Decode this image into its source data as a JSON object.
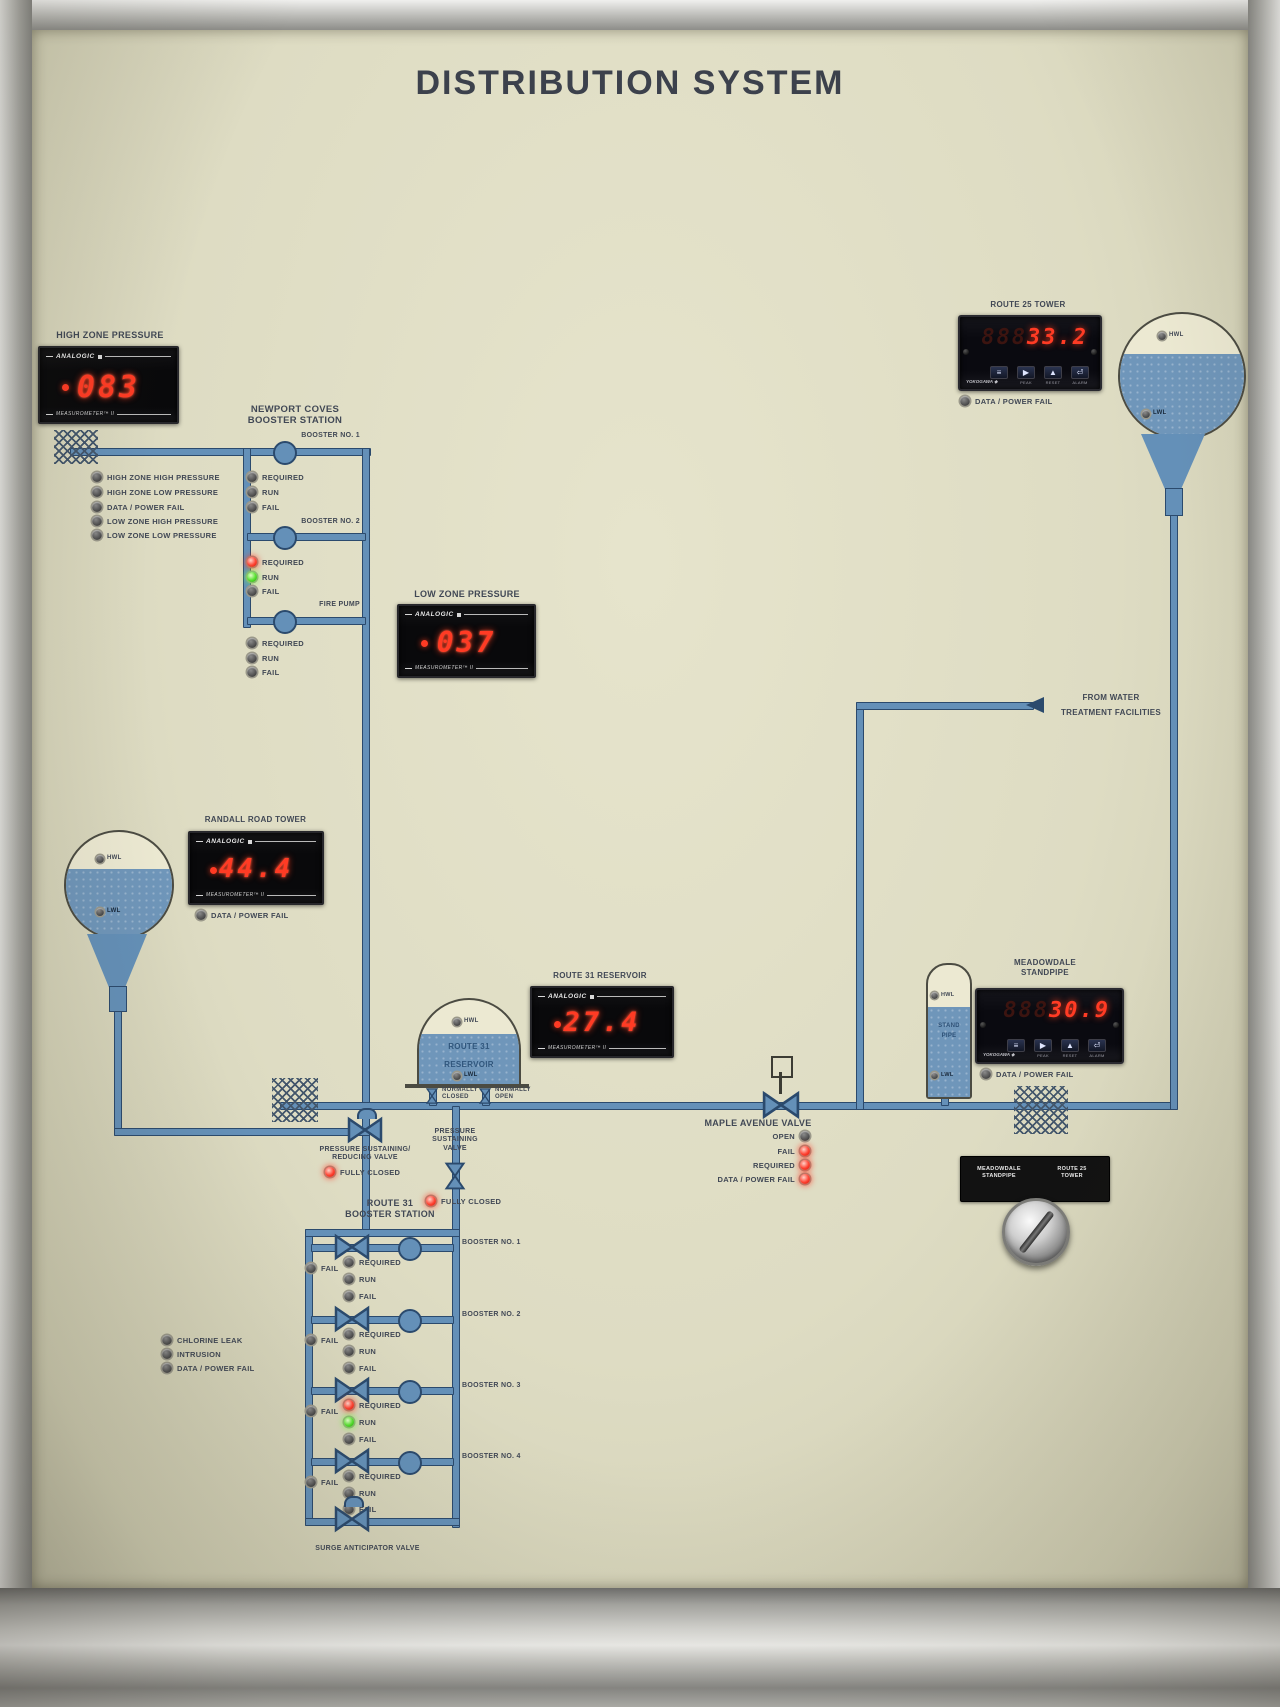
{
  "title": "DISTRIBUTION SYSTEM",
  "meters": {
    "high_zone": {
      "label": "HIGH ZONE PRESSURE",
      "value": "083",
      "brand": "ANALOGIC",
      "footer": "MEASUROMETER™ II"
    },
    "low_zone": {
      "label": "LOW ZONE PRESSURE",
      "value": "037",
      "brand": "ANALOGIC",
      "footer": "MEASUROMETER™ II"
    },
    "randall": {
      "label": "RANDALL ROAD TOWER",
      "value": "44.4",
      "brand": "ANALOGIC",
      "footer": "MEASUROMETER™ II",
      "fail": {
        "label": "DATA / POWER FAIL",
        "state": "off"
      }
    },
    "route31": {
      "label": "ROUTE 31 RESERVOIR",
      "value": "27.4",
      "brand": "ANALOGIC",
      "footer": "MEASUROMETER™ II"
    },
    "route25": {
      "label": "ROUTE 25 TOWER",
      "ghost": "888",
      "value": "33.2",
      "brand": "YOKOGAWA ◆",
      "buttons": [
        "≡",
        "▶",
        "▲",
        "⏎"
      ],
      "button_labels": [
        "",
        "PEAK",
        "RESET",
        "ALARM"
      ],
      "fail": {
        "label": "DATA / POWER FAIL",
        "state": "off"
      }
    },
    "meadowdale": {
      "label_line1": "MEADOWDALE",
      "label_line2": "STANDPIPE",
      "ghost": "888",
      "value": "30.9",
      "brand": "YOKOGAWA ◆",
      "buttons": [
        "≡",
        "▶",
        "▲",
        "⏎"
      ],
      "button_labels": [
        "",
        "PEAK",
        "RESET",
        "ALARM"
      ],
      "fail": {
        "label": "DATA / POWER FAIL",
        "state": "off"
      }
    }
  },
  "newport": {
    "title_line1": "NEWPORT COVES",
    "title_line2": "BOOSTER STATION",
    "zone_alarms": [
      {
        "label": "HIGH ZONE HIGH PRESSURE",
        "state": "off"
      },
      {
        "label": "HIGH ZONE LOW PRESSURE",
        "state": "off"
      },
      {
        "label": "DATA / POWER FAIL",
        "state": "off"
      },
      {
        "label": "LOW ZONE HIGH PRESSURE",
        "state": "off"
      },
      {
        "label": "LOW ZONE LOW PRESSURE",
        "state": "off"
      }
    ],
    "booster1": {
      "name": "BOOSTER NO. 1",
      "lights": [
        {
          "label": "REQUIRED",
          "state": "off"
        },
        {
          "label": "RUN",
          "state": "off"
        },
        {
          "label": "FAIL",
          "state": "off"
        }
      ]
    },
    "booster2": {
      "name": "BOOSTER NO. 2",
      "lights": [
        {
          "label": "REQUIRED",
          "state": "red"
        },
        {
          "label": "RUN",
          "state": "green"
        },
        {
          "label": "FAIL",
          "state": "off"
        }
      ]
    },
    "fire_pump": {
      "name": "FIRE PUMP",
      "lights": [
        {
          "label": "REQUIRED",
          "state": "off"
        },
        {
          "label": "RUN",
          "state": "off"
        },
        {
          "label": "FAIL",
          "state": "off"
        }
      ]
    }
  },
  "from_water": {
    "line1": "FROM WATER",
    "line2": "TREATMENT FACILITIES"
  },
  "towers": {
    "route25_tower": {
      "hwl": "HWL",
      "lwl": "LWL"
    },
    "randall_tower": {
      "hwl": "HWL",
      "lwl": "LWL"
    },
    "reservoir": {
      "line1": "ROUTE 31",
      "line2": "RESERVOIR",
      "hwl": "HWL",
      "lwl": "LWL",
      "valve_left_line1": "NORMALLY",
      "valve_left_line2": "CLOSED",
      "valve_right_line1": "NORMALLY",
      "valve_right_line2": "OPEN"
    },
    "standpipe": {
      "hwl": "HWL",
      "line1": "STAND",
      "line2": "PIPE",
      "lwl": "LWL"
    }
  },
  "maple": {
    "title": "MAPLE AVENUE VALVE",
    "rows": [
      {
        "label": "OPEN",
        "state": "off"
      },
      {
        "label": "FAIL",
        "state": "red"
      },
      {
        "label": "REQUIRED",
        "state": "red"
      },
      {
        "label": "DATA / POWER FAIL",
        "state": "red"
      }
    ]
  },
  "selector": {
    "left_line1": "MEADOWDALE",
    "left_line2": "STANDPIPE",
    "right_line1": "ROUTE 25",
    "right_line2": "TOWER"
  },
  "ps_reducing": {
    "line1": "PRESSURE SUSTAINING/",
    "line2": "REDUCING VALVE",
    "light": {
      "label": "FULLY CLOSED",
      "state": "red"
    }
  },
  "ps_valve": {
    "line1": "PRESSURE",
    "line2": "SUSTAINING",
    "line3": "VALVE",
    "light": {
      "label": "FULLY CLOSED",
      "state": "red"
    }
  },
  "route31_station": {
    "title_line1": "ROUTE 31",
    "title_line2": "BOOSTER STATION",
    "boosters": [
      {
        "name": "BOOSTER NO. 1",
        "fail": {
          "label": "FAIL",
          "state": "off"
        },
        "lights": [
          {
            "label": "REQUIRED",
            "state": "off"
          },
          {
            "label": "RUN",
            "state": "off"
          },
          {
            "label": "FAIL",
            "state": "off"
          }
        ]
      },
      {
        "name": "BOOSTER NO. 2",
        "fail": {
          "label": "FAIL",
          "state": "off"
        },
        "lights": [
          {
            "label": "REQUIRED",
            "state": "off"
          },
          {
            "label": "RUN",
            "state": "off"
          },
          {
            "label": "FAIL",
            "state": "off"
          }
        ]
      },
      {
        "name": "BOOSTER NO. 3",
        "fail": {
          "label": "FAIL",
          "state": "off"
        },
        "lights": [
          {
            "label": "REQUIRED",
            "state": "red"
          },
          {
            "label": "RUN",
            "state": "green"
          },
          {
            "label": "FAIL",
            "state": "off"
          }
        ]
      },
      {
        "name": "BOOSTER NO. 4",
        "fail": {
          "label": "FAIL",
          "state": "off"
        },
        "lights": [
          {
            "label": "REQUIRED",
            "state": "off"
          },
          {
            "label": "RUN",
            "state": "off"
          },
          {
            "label": "FAIL",
            "state": "off"
          }
        ]
      }
    ],
    "surge_label": "SURGE ANTICIPATOR VALVE"
  },
  "station_alarms": [
    {
      "label": "CHLORINE LEAK",
      "state": "off"
    },
    {
      "label": "INTRUSION",
      "state": "off"
    },
    {
      "label": "DATA / POWER FAIL",
      "state": "off"
    }
  ]
}
